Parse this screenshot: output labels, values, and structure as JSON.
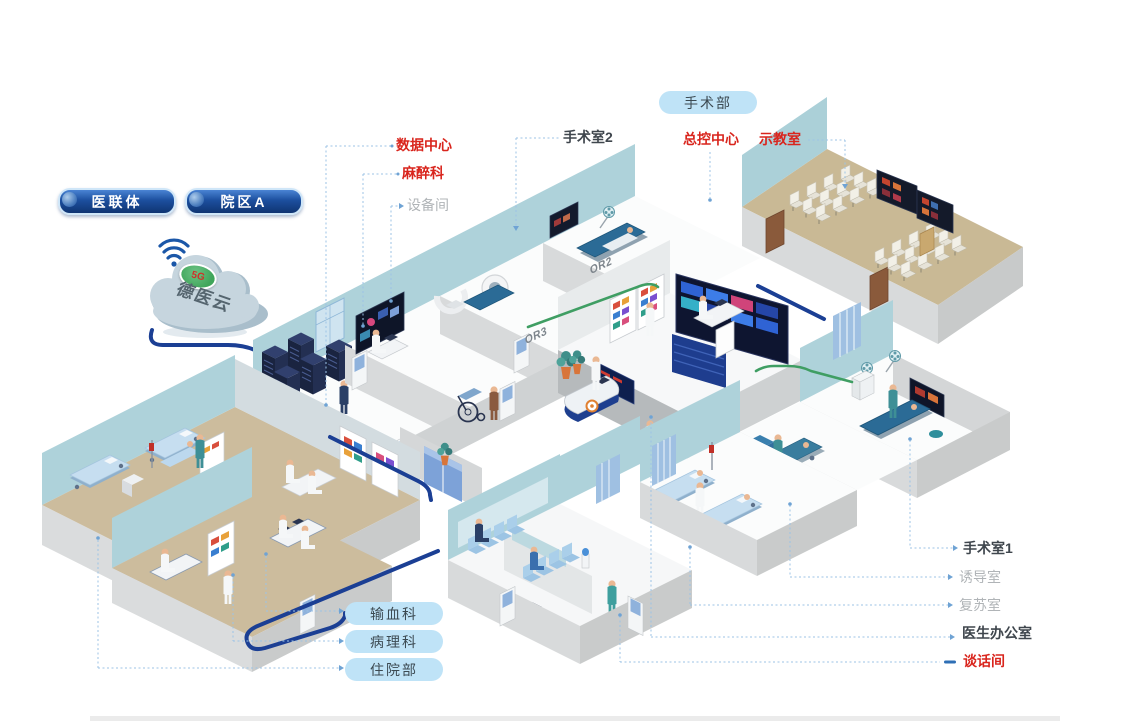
{
  "cloud": {
    "platform_name": "德医云",
    "badge": "5G"
  },
  "network_pills": [
    {
      "label": "医联体"
    },
    {
      "label": "院区A"
    }
  ],
  "department_pill": {
    "label": "手术部"
  },
  "callouts": {
    "data_center": "数据中心",
    "anesthesia": "麻醉科",
    "equipment_room": "设备间",
    "operating_room_2": "手术室2",
    "master_control": "总控中心",
    "demo_classroom": "示教室",
    "operating_room_1": "手术室1",
    "induction_room": "诱导室",
    "recovery_room": "复苏室",
    "doctor_office": "医生办公室",
    "talk_room": "谈话间"
  },
  "department_links": [
    {
      "label": "输血科"
    },
    {
      "label": "病理科"
    },
    {
      "label": "住院部"
    }
  ],
  "wall_labels": {
    "or2": "OR2",
    "or3": "OR3"
  },
  "colors": {
    "label_red": "#d9251d",
    "label_dark": "#3f464d",
    "label_gray": "#b0b4b7",
    "callout_line": "#9cc3e6",
    "cable_navy": "#1b3f94",
    "cable_green": "#3f9e63",
    "pill_light_bg": "#bfe3f7",
    "pill_dark": "#123a78",
    "wall_teal": "#aed2da",
    "floor_tan": "#ccbc9d"
  }
}
